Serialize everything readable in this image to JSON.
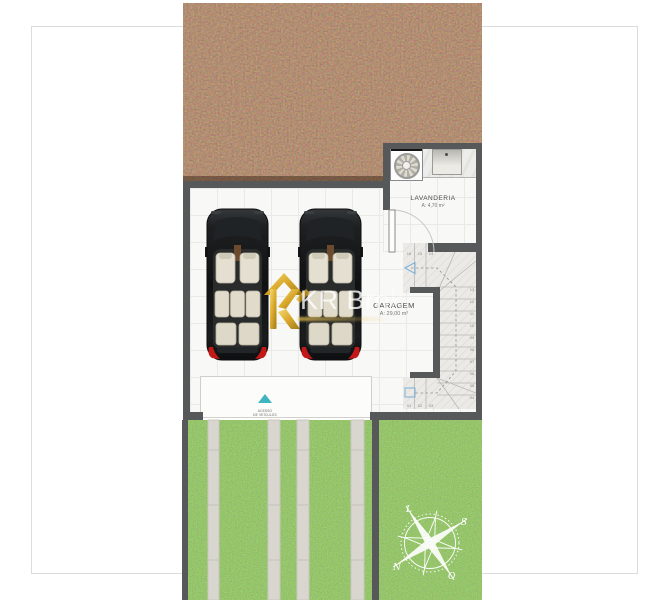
{
  "rooms": {
    "lavanderia": {
      "name": "LAVANDERIA",
      "area": "A: 4,70 m²"
    },
    "garagem": {
      "name": "GARAGEM",
      "area": "A: 29,00 m²"
    }
  },
  "access": {
    "line1": "ACESSO",
    "line2": "DE VEÍCULOS"
  },
  "compass": {
    "north": "N",
    "south": "S",
    "east": "L",
    "west": "O"
  },
  "stairs": {
    "steps": [
      "01",
      "02",
      "03",
      "04",
      "05",
      "06",
      "07",
      "08",
      "09",
      "10",
      "11",
      "12",
      "13",
      "14",
      "15",
      "16"
    ]
  },
  "watermark": {
    "brand": "KR Broker"
  },
  "colors": {
    "wall": "#57585a",
    "soil": "#5d3a28",
    "grass": "#68993e",
    "concrete": "#d8d6ce",
    "accent_teal": "#3fb5bf",
    "brand_gold": "#d9a521",
    "taillight": "#c21818"
  }
}
